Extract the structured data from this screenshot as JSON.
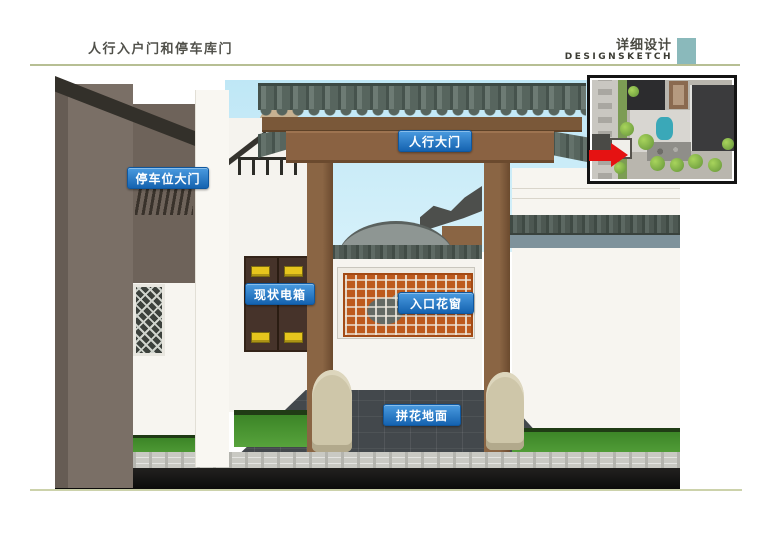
{
  "header": {
    "title": "人行入户门和停车库门",
    "subtitle_cn": "详细设计",
    "subtitle_en": "DESIGNSKETCH"
  },
  "annotations": {
    "pedestrian_gate": "人行大门",
    "parking_gate": "停车位大门",
    "electric_box": "现状电箱",
    "entry_lattice_window": "入口花窗",
    "paving": "拼花地面"
  },
  "colors": {
    "badge_blue": "#1563b0",
    "accent_teal": "#8ab9bb",
    "rule_olive": "#b7bf94",
    "sky": "#c3e9f6",
    "arrow_red": "#e51212",
    "wood_brown": "#7a573a",
    "roof_gray": "#57655e",
    "wall_taupe": "#7a6f66",
    "lattice_orange": "#bd5a1d",
    "grass_green": "#4e9937"
  }
}
